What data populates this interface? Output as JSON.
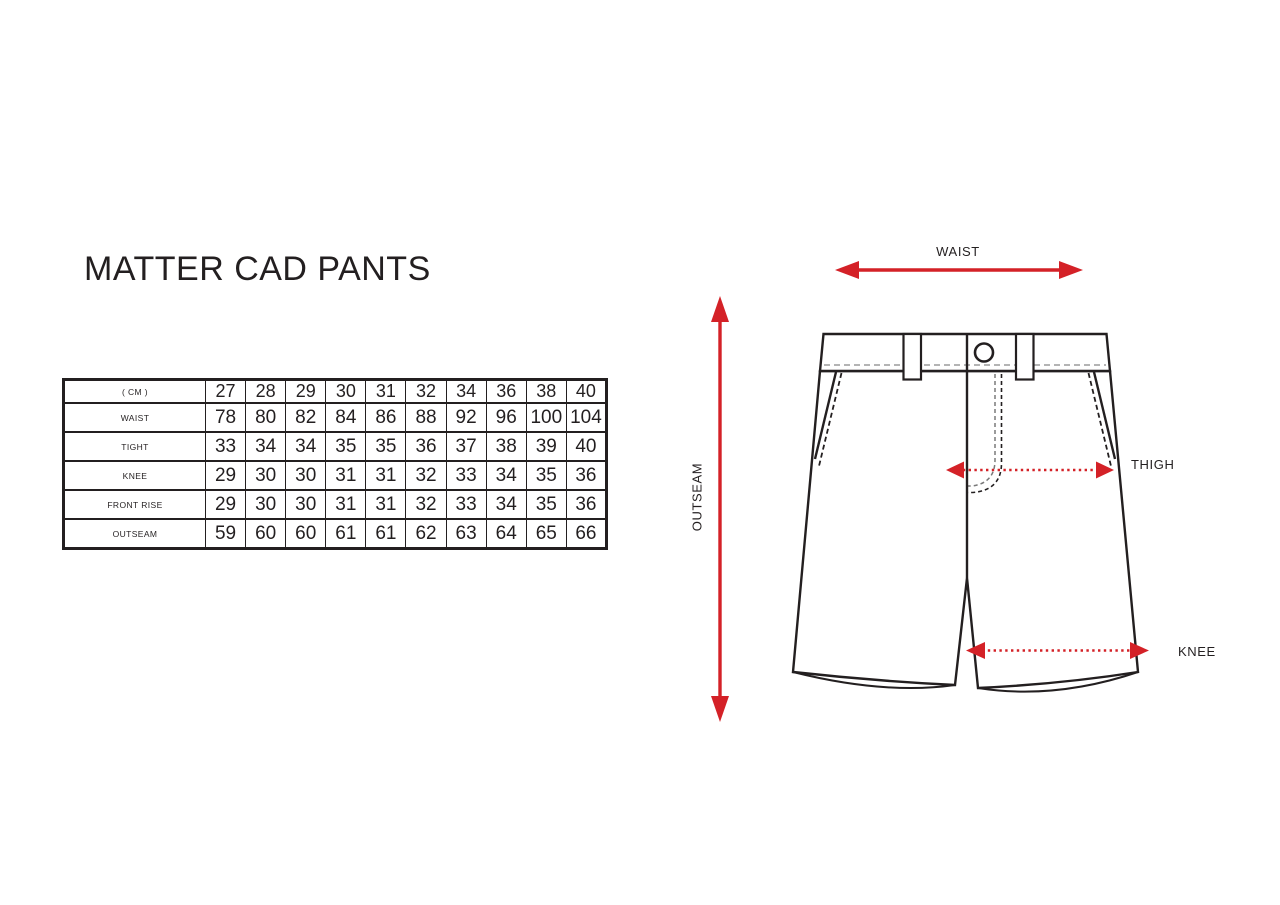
{
  "title": "MATTER CAD PANTS",
  "size_table": {
    "unit_header": "( CM )",
    "sizes": [
      "27",
      "28",
      "29",
      "30",
      "31",
      "32",
      "34",
      "36",
      "38",
      "40"
    ],
    "rows": [
      {
        "label": "WAIST",
        "values": [
          "78",
          "80",
          "82",
          "84",
          "86",
          "88",
          "92",
          "96",
          "100",
          "104"
        ]
      },
      {
        "label": "TIGHT",
        "values": [
          "33",
          "34",
          "34",
          "35",
          "35",
          "36",
          "37",
          "38",
          "39",
          "40"
        ]
      },
      {
        "label": "KNEE",
        "values": [
          "29",
          "30",
          "30",
          "31",
          "31",
          "32",
          "33",
          "34",
          "35",
          "36"
        ]
      },
      {
        "label": "FRONT RISE",
        "values": [
          "29",
          "30",
          "30",
          "31",
          "31",
          "32",
          "33",
          "34",
          "35",
          "36"
        ]
      },
      {
        "label": "OUTSEAM",
        "values": [
          "59",
          "60",
          "60",
          "61",
          "61",
          "62",
          "63",
          "64",
          "65",
          "66"
        ]
      }
    ]
  },
  "diagram": {
    "labels": {
      "waist": "WAIST",
      "outseam": "OUTSEAM",
      "thigh": "THIGH",
      "knee": "KNEE"
    }
  },
  "colors": {
    "accent_red": "#d42127",
    "ink": "#231f20",
    "stitch_gray": "#9b9b9b",
    "fly_gray": "#7a7a7a"
  }
}
